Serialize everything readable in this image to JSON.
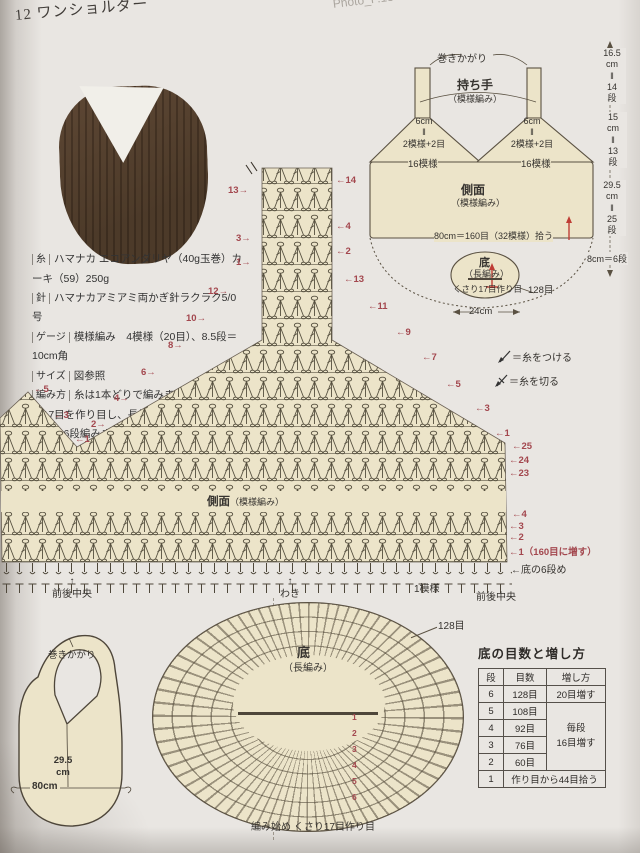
{
  "header": {
    "number_title": "12 ワンショルダー",
    "photo_ref": "Photo_P.13"
  },
  "info": {
    "rows": [
      {
        "label": "糸",
        "text": "ハマナカ エコアンダリヤ（40g玉巻）カーキ（59）250g"
      },
      {
        "label": "針",
        "text": "ハマナカアミアミ両かぎ針ラクラク5/0号"
      },
      {
        "label": "ゲージ",
        "text": "模様編み　4模様（20目）、8.5段＝10cm角"
      },
      {
        "label": "サイズ",
        "text": "図参照"
      },
      {
        "label": "編み方",
        "text": "糸は1本どりで編みます。底はくさり17目を作り目し、長編みで図のように増しながら6段編みます。続けて側面を160目（32模様）に増しながら拾い目し、模様編みで25段編んで糸を切ります。指定の位置に糸をつけ、側面を2つに分けて図のように減らしながら編み、続けて持ち手を編みます。両側の持ち手を巻きかがりでつなぎます"
      }
    ]
  },
  "legend": {
    "attach": "＝糸をつける",
    "cut": "＝糸を切る"
  },
  "schematic": {
    "whip": "巻きかがり",
    "handle": "持ち手",
    "handle_sub": "（模様編み）",
    "strap_spec": "6cm\n‖\n2模様+2目",
    "pat16": "16模様",
    "side": "側面",
    "side_sub": "（模様編み）",
    "pickup": "80cm＝160目（32模様）拾う",
    "bottom": "底",
    "bottom_sub": "（長編み）",
    "cast": "くさり17目作り目",
    "st128": "128目",
    "w24": "24cm",
    "m1": "16.5\ncm\n‖\n14\n段",
    "m2": "15\ncm\n‖\n13\n段",
    "m3": "29.5\ncm\n‖\n25\n段",
    "m4": "8cm＝6段"
  },
  "chart": {
    "side": "側面",
    "side_sub": "（模様編み）",
    "nums": {
      "n13l": "13→",
      "n14r": "←14",
      "n3l": "3→",
      "n4r": "←4",
      "n1l": "1→",
      "n2r": "←2",
      "n12l": "12→",
      "n13r": "←13",
      "n11r": "←11",
      "n10l": "10→",
      "n9r": "←9",
      "n8l": "8→",
      "n7r": "←7",
      "n6l": "6→",
      "n5r": "←5",
      "n4l": "4→",
      "n3r": "←3",
      "n2l": "2→",
      "n1r": "←1",
      "p5": "←5",
      "p3": "←3",
      "p1": "←1",
      "r25": "←25",
      "r24": "←24",
      "r23": "←23",
      "b4": "←4",
      "b3": "←3",
      "b2": "←2",
      "b1": "←1（160目に増す）",
      "b0": "←底の6段め"
    },
    "labels": {
      "bc_l": "↑\n前後中央",
      "waki": "↑\nわき",
      "one": "1模様",
      "bc_r": "前後中央"
    }
  },
  "bag": {
    "whip": "巻きかがり",
    "height": "29.5\ncm",
    "width": "80cm"
  },
  "oval": {
    "bottom": "底",
    "bottom_sub": "（長編み）",
    "start": "編み始め くさり17目作り目",
    "st128": "128目",
    "digits": [
      "1",
      "2",
      "3",
      "4",
      "5",
      "6"
    ]
  },
  "table": {
    "title": "底の目数と増し方",
    "headers": [
      "段",
      "目数",
      "増し方"
    ],
    "rows": [
      [
        "6",
        "128目"
      ],
      [
        "5",
        "108目"
      ],
      [
        "4",
        "92目"
      ],
      [
        "3",
        "76目"
      ],
      [
        "2",
        "60目"
      ],
      [
        "1",
        "作り目から44目拾う"
      ]
    ],
    "inc_first": "20目増す",
    "inc_merged": "毎段\n16目増す"
  }
}
